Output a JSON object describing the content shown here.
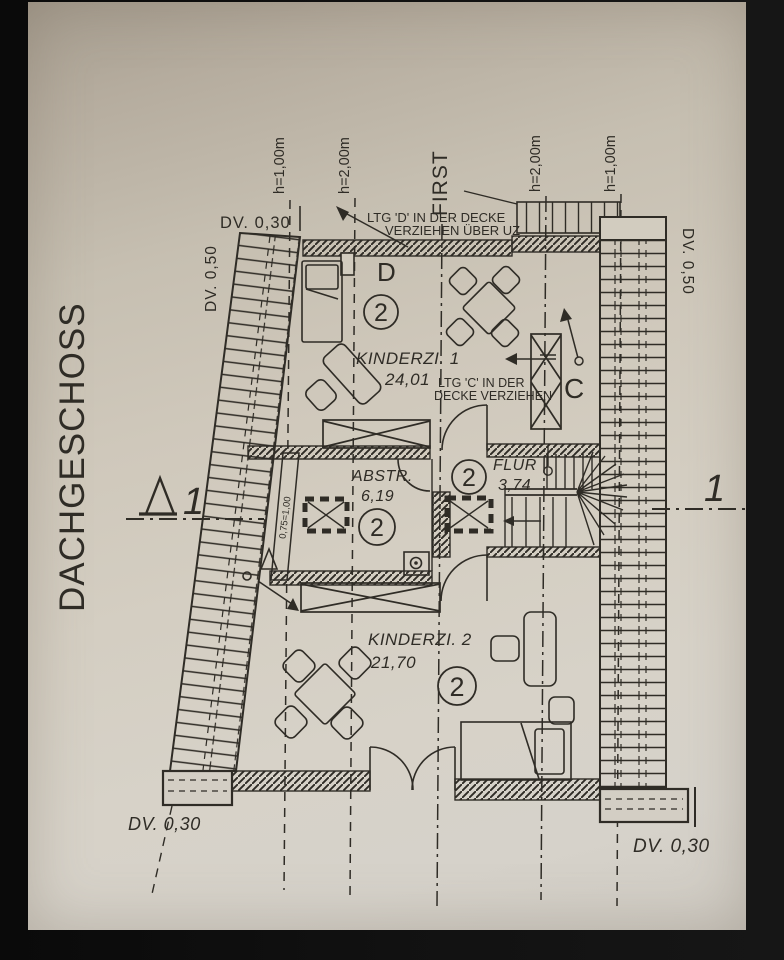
{
  "floor_title": "DACHGESCHOSS",
  "dims": {
    "top_left": "DV. 0,30",
    "left": "DV. 0,50",
    "right": "DV. 0,50",
    "bottom_left": "DV. 0,30",
    "bottom_right": "DV. 0,30"
  },
  "height_lines": {
    "l1": "h=1,00m",
    "l2": "h=2,00m",
    "first": "FIRST",
    "l3": "h=2,00m",
    "l4": "h=1,00m"
  },
  "rooms": {
    "k1": {
      "name": "KINDERZI. 1",
      "area": "24,01",
      "badge": "2"
    },
    "abstr": {
      "name": "ABSTR.",
      "area": "6,19",
      "badge": "2"
    },
    "flur": {
      "name": "FLUR",
      "area": "3,74",
      "badge": "2"
    },
    "k2": {
      "name": "KINDERZI. 2",
      "area": "21,70",
      "badge": "2"
    }
  },
  "annotations": {
    "ltg_d1": "LTG 'D' IN DER DECKE",
    "ltg_d2": "VERZIEHEN ÜBER UZ",
    "ltg_c1": "LTG 'C' IN DER",
    "ltg_c2": "DECKE VERZIEHEN",
    "door_d": "D",
    "door_c": "C",
    "window_note": "0,75=1,00",
    "section_left": "1",
    "section_right": "1"
  },
  "colors": {
    "ink": "#2f2c26",
    "paper": "#cfc8bb",
    "background": "#0c0c0c"
  }
}
